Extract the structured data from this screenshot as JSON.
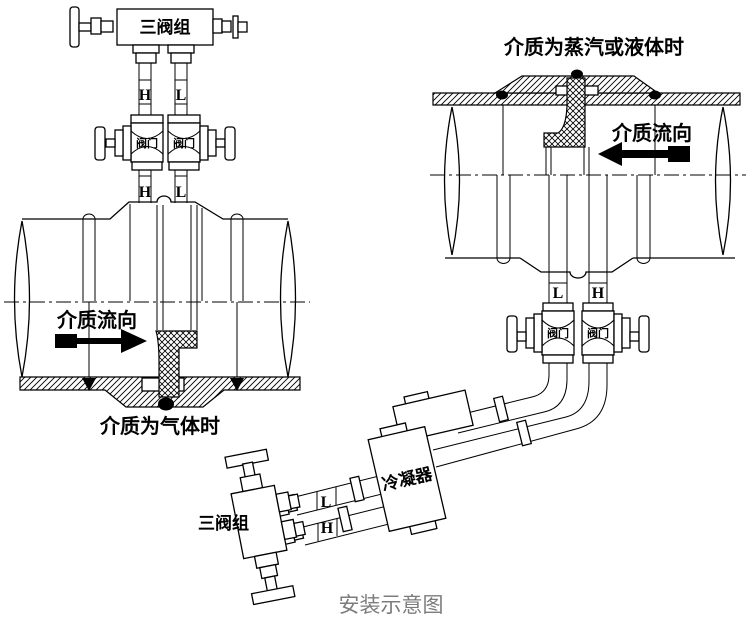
{
  "colors": {
    "line": "#000000",
    "background": "#ffffff",
    "caption_gray": "#7c7c7c"
  },
  "gas_installation": {
    "manifold_label": "三阀组",
    "taps": {
      "high": "H",
      "low": "L"
    },
    "valve_label": "阀门",
    "flow_label": "介质流向",
    "caption": "介质为气体时"
  },
  "steam_installation": {
    "title": "介质为蒸汽或液体时",
    "flow_label": "介质流向",
    "taps": {
      "high": "H",
      "low": "L"
    },
    "valve_label": "阀门",
    "condenser_label": "冷凝器",
    "manifold_label": "三阀组"
  },
  "footer": {
    "caption": "安装示意图"
  }
}
